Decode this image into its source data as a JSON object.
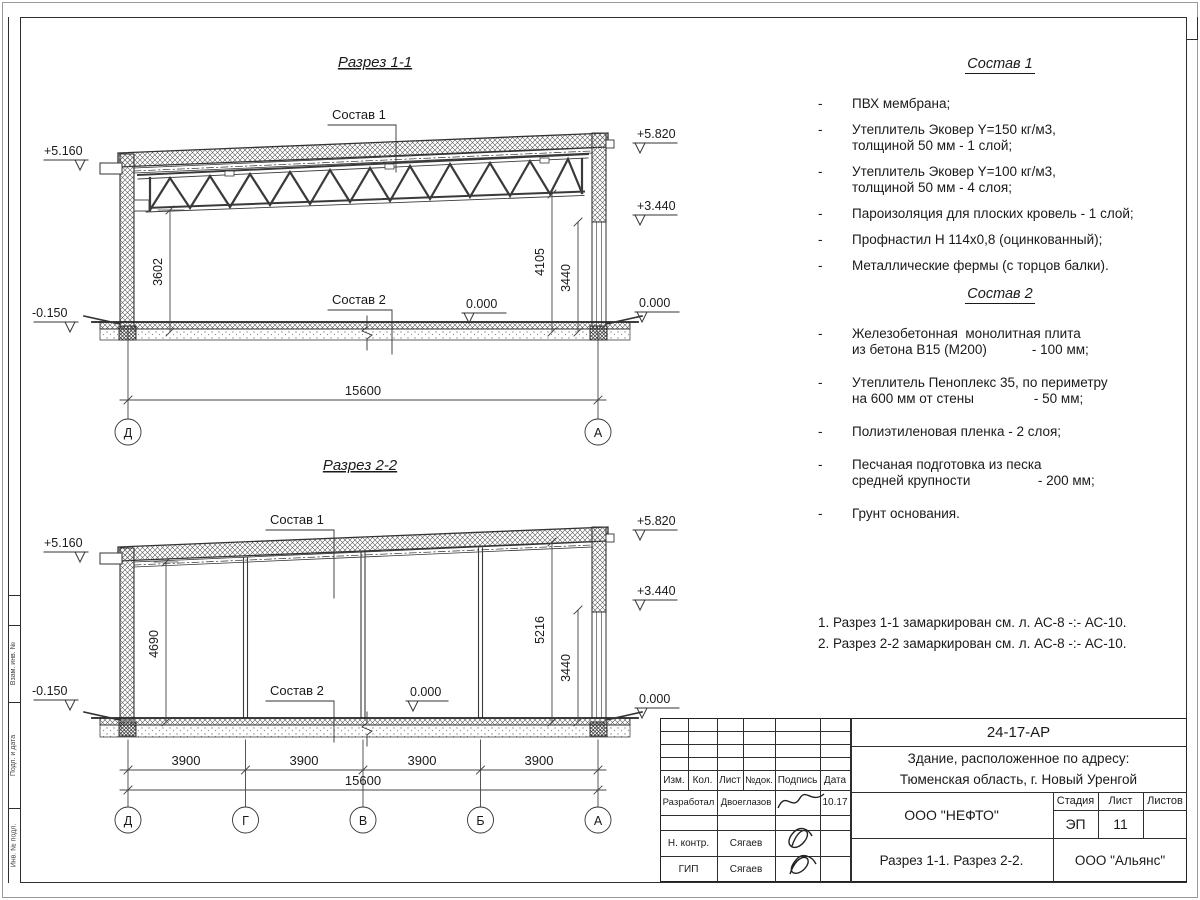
{
  "sheet": {
    "side_strip_labels": [
      "Взам. инв. №",
      "Подп. и дата",
      "Инв. № подл."
    ]
  },
  "common": {
    "sostav1_label": "Состав 1",
    "sostav2_label": "Состав 2",
    "elev_516": "+5.160",
    "elev_582": "+5.820",
    "elev_344": "+3.440",
    "elev_zero": "0.000",
    "elev_minus015": "-0.150"
  },
  "section1": {
    "title": "Разрез 1-1",
    "dim_v1": "3602",
    "dim_v2": "4105",
    "dim_v3": "3440",
    "dim_total": "15600",
    "axes": [
      "Д",
      "А"
    ]
  },
  "section2": {
    "title": "Разрез 2-2",
    "dim_v1": "4690",
    "dim_v2": "5216",
    "dim_v3": "3440",
    "spans": [
      "3900",
      "3900",
      "3900",
      "3900"
    ],
    "dim_total": "15600",
    "axes": [
      "Д",
      "Г",
      "В",
      "Б",
      "А"
    ]
  },
  "sostav1": {
    "title": "Состав 1",
    "items": [
      "ПВХ мембрана;",
      "Утеплитель Эковер Y=150 кг/м3,\nтолщиной 50 мм - 1 слой;",
      "Утеплитель Эковер Y=100 кг/м3,\nтолщиной 50 мм - 4 слоя;",
      "Пароизоляция для плоских кровель - 1 слой;",
      "Профнастил Н 114х0,8 (оцинкованный);",
      "Металлические фермы (с торцов балки)."
    ]
  },
  "sostav2": {
    "title": "Состав 2",
    "items": [
      "Железобетонная  монолитная плита\nиз бетона В15 (М200)            - 100 мм;",
      "Утеплитель Пеноплекс 35, по периметру\nна 600 мм от стены                - 50 мм;",
      "Полиэтиленовая пленка - 2 слоя;",
      "Песчаная подготовка из песка\nсредней крупности                  - 200 мм;",
      "Грунт основания."
    ]
  },
  "notes": {
    "line1": "1. Разрез 1-1 замаркирован см. л. АС-8 -:- АС-10.",
    "line2": "2. Разрез 2-2 замаркирован см. л. АС-8 -:- АС-10."
  },
  "titleblock": {
    "doc_number": "24-17-АР",
    "object_line1": "Здание, расположенное по адресу:",
    "object_line2": "Тюменская область, г. Новый Уренгой",
    "col_izm": "Изм.",
    "col_kol": "Кол.",
    "col_list": "Лист",
    "col_dok": "№док.",
    "col_podpis": "Подпись",
    "col_data": "Дата",
    "row1_role": "Разработал",
    "row1_name": "Двоеглазов",
    "row1_date": "10.17",
    "row2_role": "Н. контр.",
    "row2_name": "Сягаев",
    "row3_role": "ГИП",
    "row3_name": "Сягаев",
    "company": "ООО \"НЕФТО\"",
    "sheet_name": "Разрез 1-1. Разрез 2-2.",
    "firm": "ООО \"Альянс\"",
    "stage_label": "Стадия",
    "list_label": "Лист",
    "listov_label": "Листов",
    "stage_value": "ЭП",
    "list_value": "11",
    "listov_value": ""
  }
}
